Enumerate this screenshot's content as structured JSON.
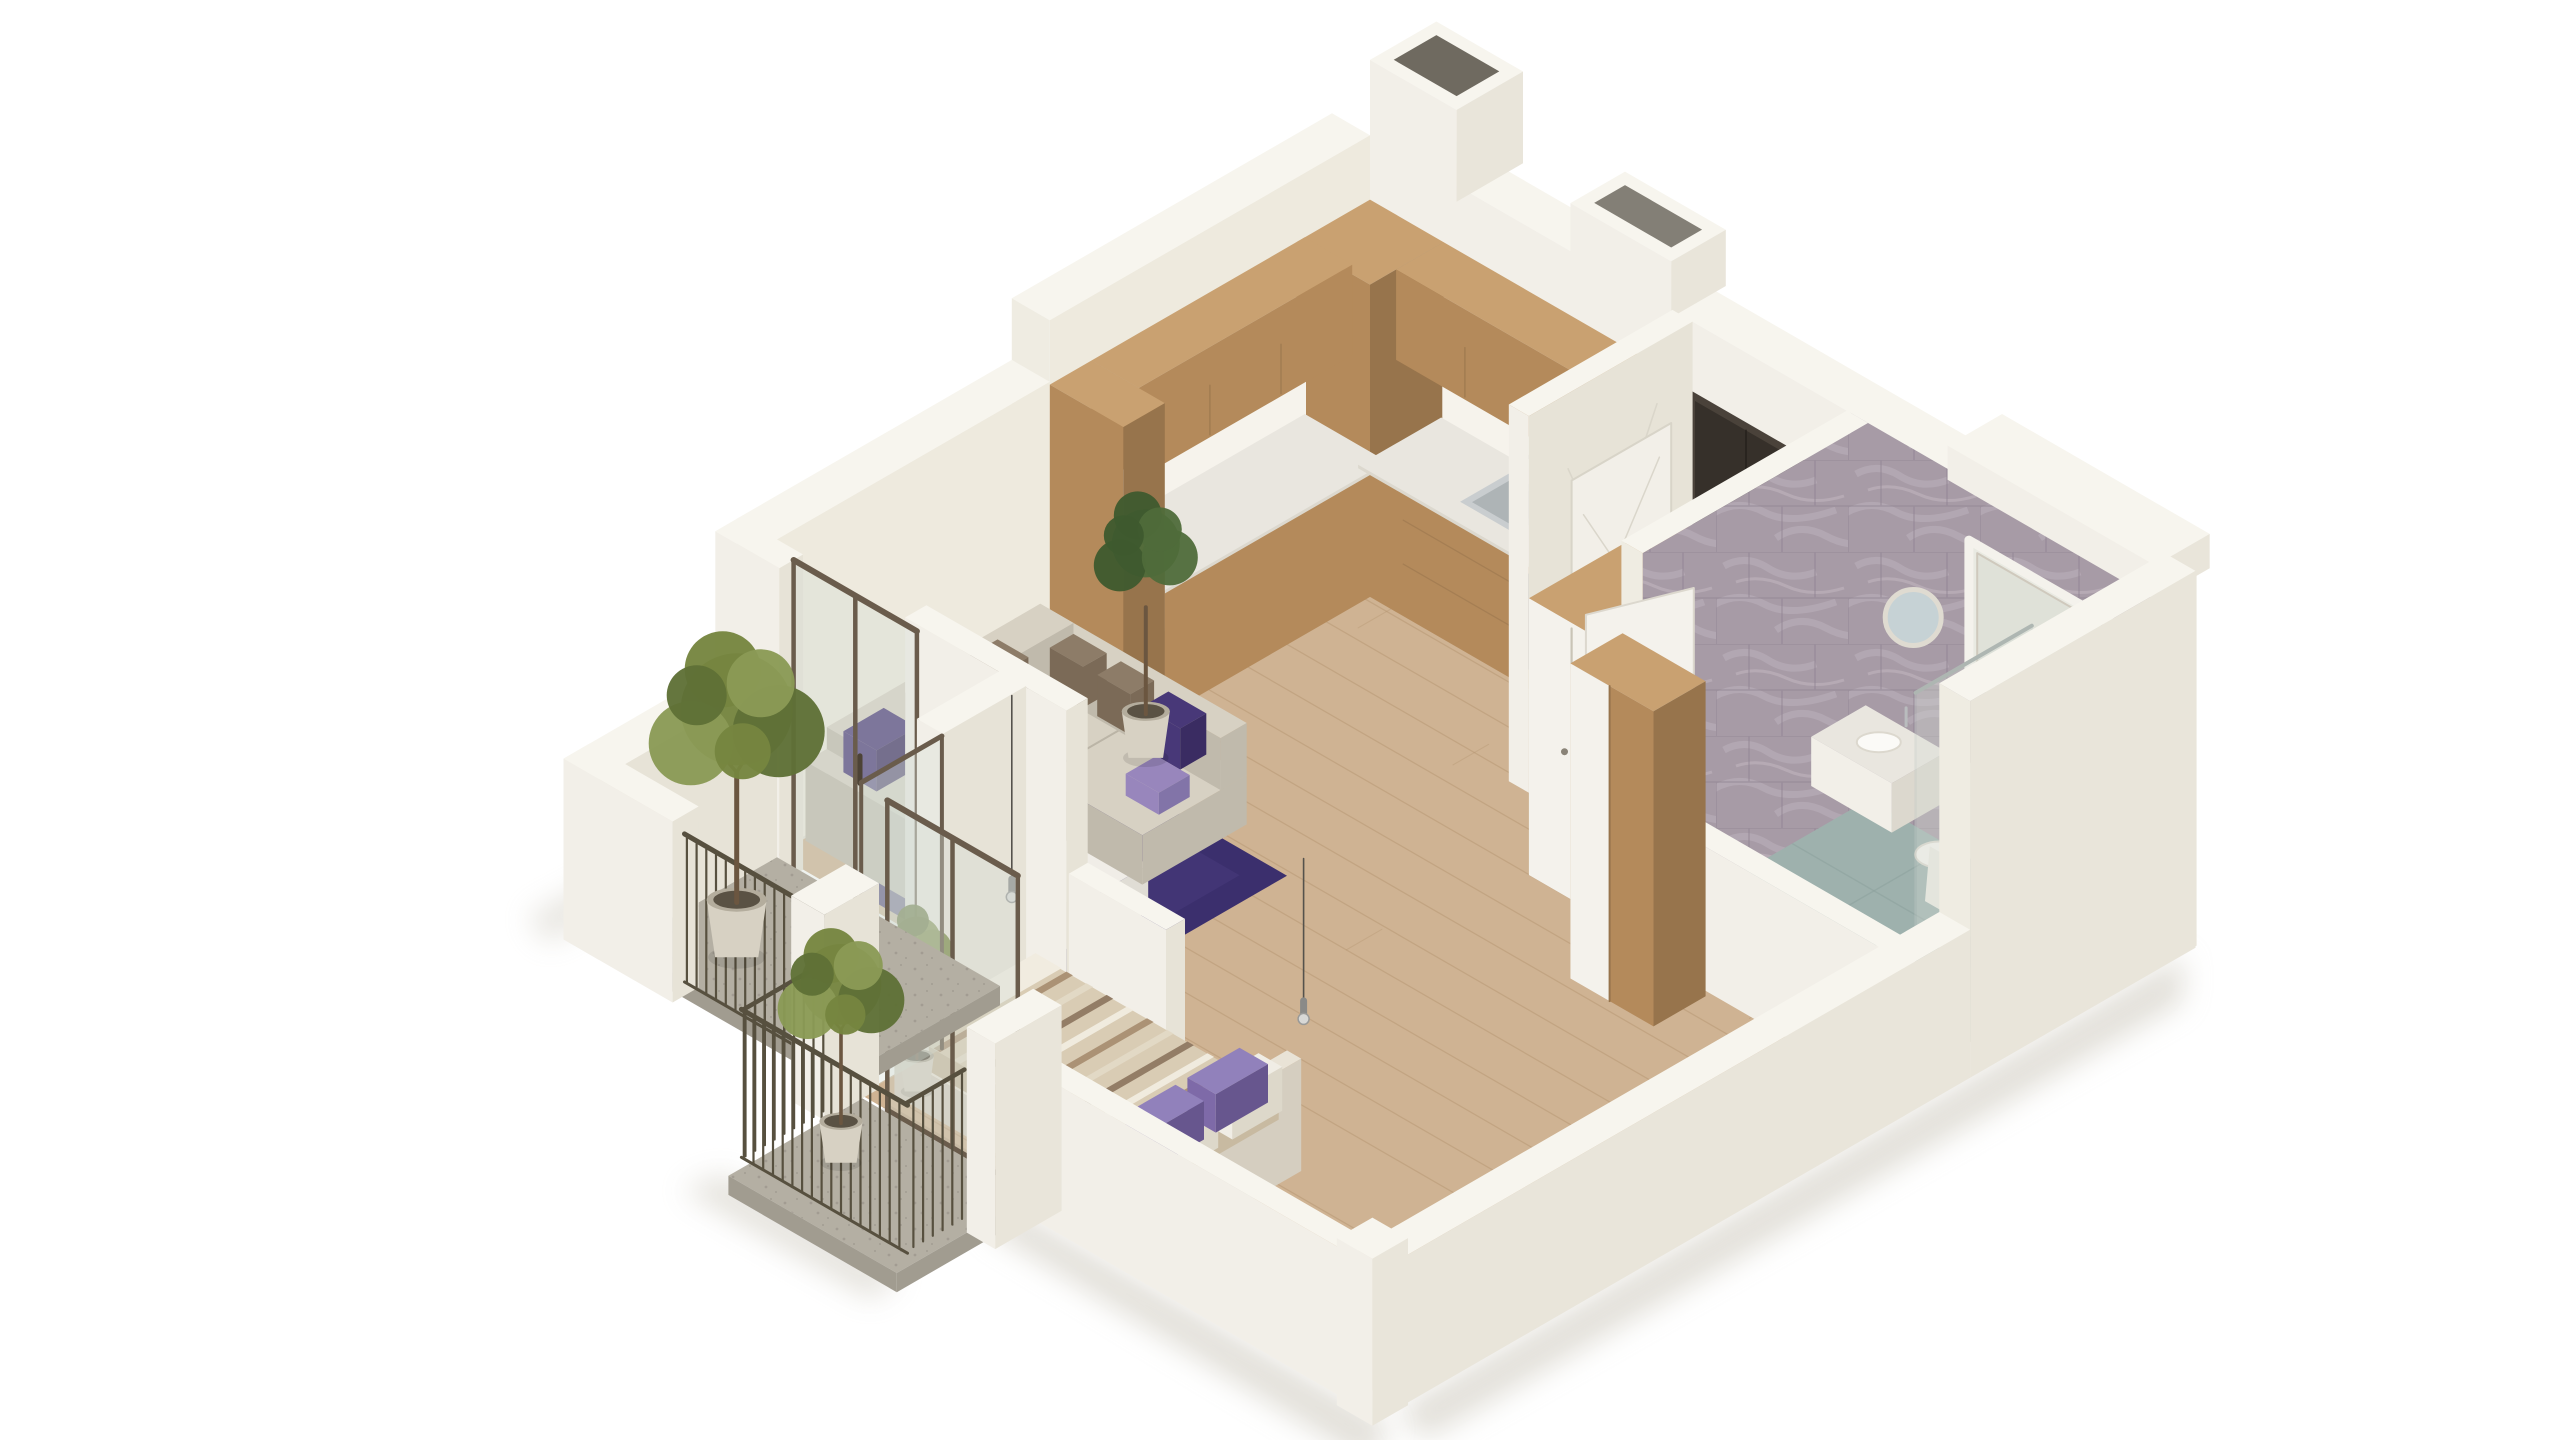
{
  "app": {
    "type": "isometric-3d-floor-plan-render",
    "background": "#ffffff",
    "view": "cutaway one-bedroom apartment, axonometric from south-west"
  },
  "palette": {
    "bg": "#ffffff",
    "wall_bright": "#f2efe8",
    "wall_face": "#eeeade",
    "wall_face2": "#e7e3d7",
    "wall_top": "#f7f5ee",
    "wall_cut": "#efece2",
    "wall_outer": "#e9e5da",
    "wall_shade": "#d8d4c7",
    "vent_dark": "#6f6a60",
    "floor_wood": "#cfb393",
    "floor_wood_line": "#b3946f",
    "wood_light": "#c9a171",
    "wood_mid": "#b48a5b",
    "wood_dark": "#97744c",
    "counter": "#e9e6df",
    "backsplash": "#f6f3ec",
    "sink_steel": "#c9cdcf",
    "sink_inner": "#aeb4b6",
    "faucet": "#b9bcbe",
    "oven_dark": "#2e2b27",
    "decor_disc": "#dcc9a4",
    "door_dark": "#36302a",
    "door_frame": "#4a423a",
    "handle": "#c8cacc",
    "panel_line": "#d8d4c8",
    "marble_tile": "#a79ba6",
    "marble_vein": "#bcb1bb",
    "marble_grout": "#8e8290",
    "bath_floor": "#9eb1ad",
    "bath_floor_dark": "#8ca19d",
    "fixture_white": "#f4f2ec",
    "fixture_shadow": "#dcd8ce",
    "mirror": "#c6d2d5",
    "glass_tint": "#d6ddd6",
    "glass_edge": "#c2cbc8",
    "metal_frame": "#6a5c4c",
    "railing": "#57503f",
    "balcony_floor": "#b4afa3",
    "balcony_floor_side": "#a19c90",
    "balcony_speck": "#9a958a",
    "rug": "#3b2f6d",
    "rug_light": "#473a7c",
    "sofa": "#d7d1c3",
    "sofa_side": "#c0baac",
    "sofa_dark": "#aaa496",
    "pillow_brown": "#7b6a57",
    "pillow_brown2": "#8d7c68",
    "pillow_purple": "#483878",
    "pillow_lavender": "#9886bc",
    "table_top": "#f0ede7",
    "table_side": "#e0ddd5",
    "vein_gray": "#d8d4cb",
    "bed_base": "#e9e3d6",
    "bed_side": "#d5cec0",
    "sheet_white": "#f1ece0",
    "blanket": "#d9ccb4",
    "blanket_side": "#c8baa1",
    "stripe1": "#a98e72",
    "stripe2": "#8f7862",
    "stripe3": "#e3d9c6",
    "bed_pillow_purple": "#7e6aa8",
    "bed_pillow_purple_top": "#9181bb",
    "plant_green": "#76853f",
    "plant_green_dark": "#5f7036",
    "plant_green_light": "#8a9a55",
    "plant_indoor": "#4f6b3a",
    "plant_indoor2": "#3e5a2e",
    "pot": "#d7d1c3",
    "pot_dark": "#b4ad9d",
    "trunk": "#6b5640",
    "cord": "#55524c",
    "chrome": "#d8d8d6",
    "ground_shadow": "#c6c1b4"
  },
  "scene": {
    "building": "one-bedroom-apartment-cutaway",
    "rooms": [
      {
        "name": "kitchen",
        "items": [
          "corner-cabinet-tower",
          "upper-cabinets",
          "lower-cabinets",
          "counter",
          "sink",
          "faucet",
          "oven",
          "decor-disc"
        ]
      },
      {
        "name": "living-room",
        "items": [
          "sectional-sofa",
          "sofa-pillows",
          "purple-rug",
          "marble-coffee-table",
          "indoor-plant",
          "balcony-glass-door"
        ]
      },
      {
        "name": "hallway",
        "items": [
          "entrance-door",
          "interior-door",
          "wardrobe"
        ]
      },
      {
        "name": "bathroom",
        "items": [
          "marble-walls",
          "window-recess",
          "vanity",
          "round-mirror",
          "toilet",
          "shower-glass",
          "shower-head",
          "bench"
        ]
      },
      {
        "name": "bedroom",
        "items": [
          "double-bed",
          "striped-blanket",
          "purple-pillows",
          "pendant-lights",
          "wood-closet",
          "corner-plant",
          "balcony-glass-door"
        ]
      },
      {
        "name": "balcony-1",
        "items": [
          "concrete-floor",
          "white-parapet",
          "metal-railing",
          "potted-tree"
        ]
      },
      {
        "name": "balcony-2",
        "items": [
          "concrete-floor",
          "white-parapet",
          "metal-railing",
          "potted-tree"
        ]
      }
    ]
  }
}
